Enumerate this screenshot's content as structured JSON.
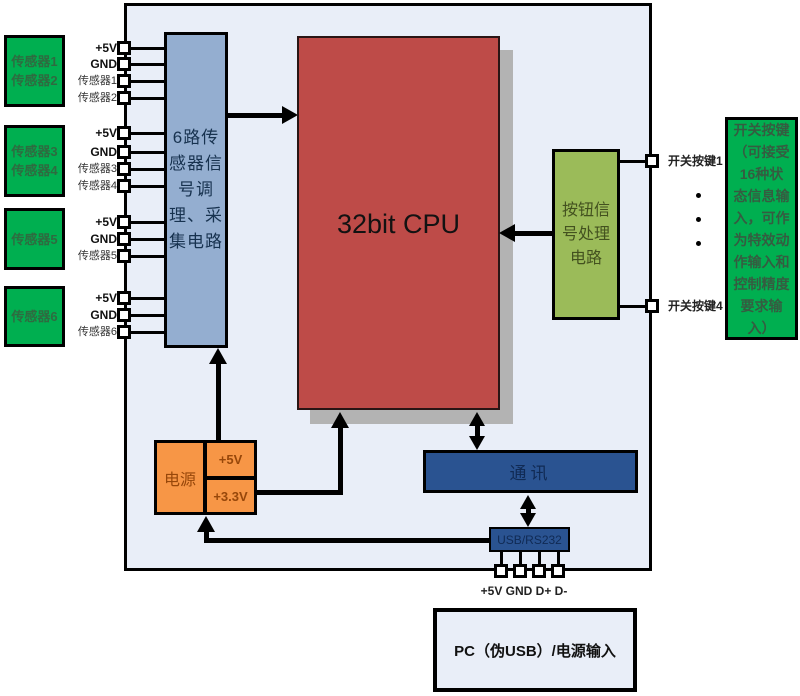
{
  "diagram": {
    "title": "sensor-cpu-block-diagram",
    "sensor_boxes": [
      "传感器1\n传感器2",
      "传感器3\n传感器4",
      "传感器5",
      "传感器6"
    ],
    "left_pins": [
      "+5V",
      "GND",
      "传感器1",
      "传感器2",
      "+5V",
      "GND",
      "传感器3",
      "传感器4",
      "+5V",
      "GND",
      "传感器5",
      "+5V",
      "GND",
      "传感器6"
    ],
    "blocks": {
      "signal_conditioning": "6路传\n感器信\n号调\n理、采\n集电路",
      "cpu": "32bit CPU",
      "button_circuit": "按钮信\n号处理\n电路",
      "comm": "通讯",
      "usb": "USB/RS232"
    },
    "switch_keys": [
      "开关按键1",
      "开关按键4"
    ],
    "switch_note": "开关按键\n（可接受\n16种状\n态信息输\n入，可作\n为特效动\n作输入和\n控制精度\n要求输\n入）",
    "power": {
      "main": "电源",
      "rail_5v": "+5V",
      "rail_3v3": "+3.3V"
    },
    "usb_pins_label": "+5V GND D+ D-",
    "pc_input": "PC（伪USB）/电源输入",
    "colors": {
      "container_fill": "#E9EEF8",
      "sensor_green": "#00AF50",
      "conditioning_blue": "#94AED0",
      "cpu_red": "#BE4B48",
      "button_olive": "#9BBB59",
      "power_orange": "#F79646",
      "comm_navy": "#2A5391",
      "line_black": "#000000"
    }
  }
}
